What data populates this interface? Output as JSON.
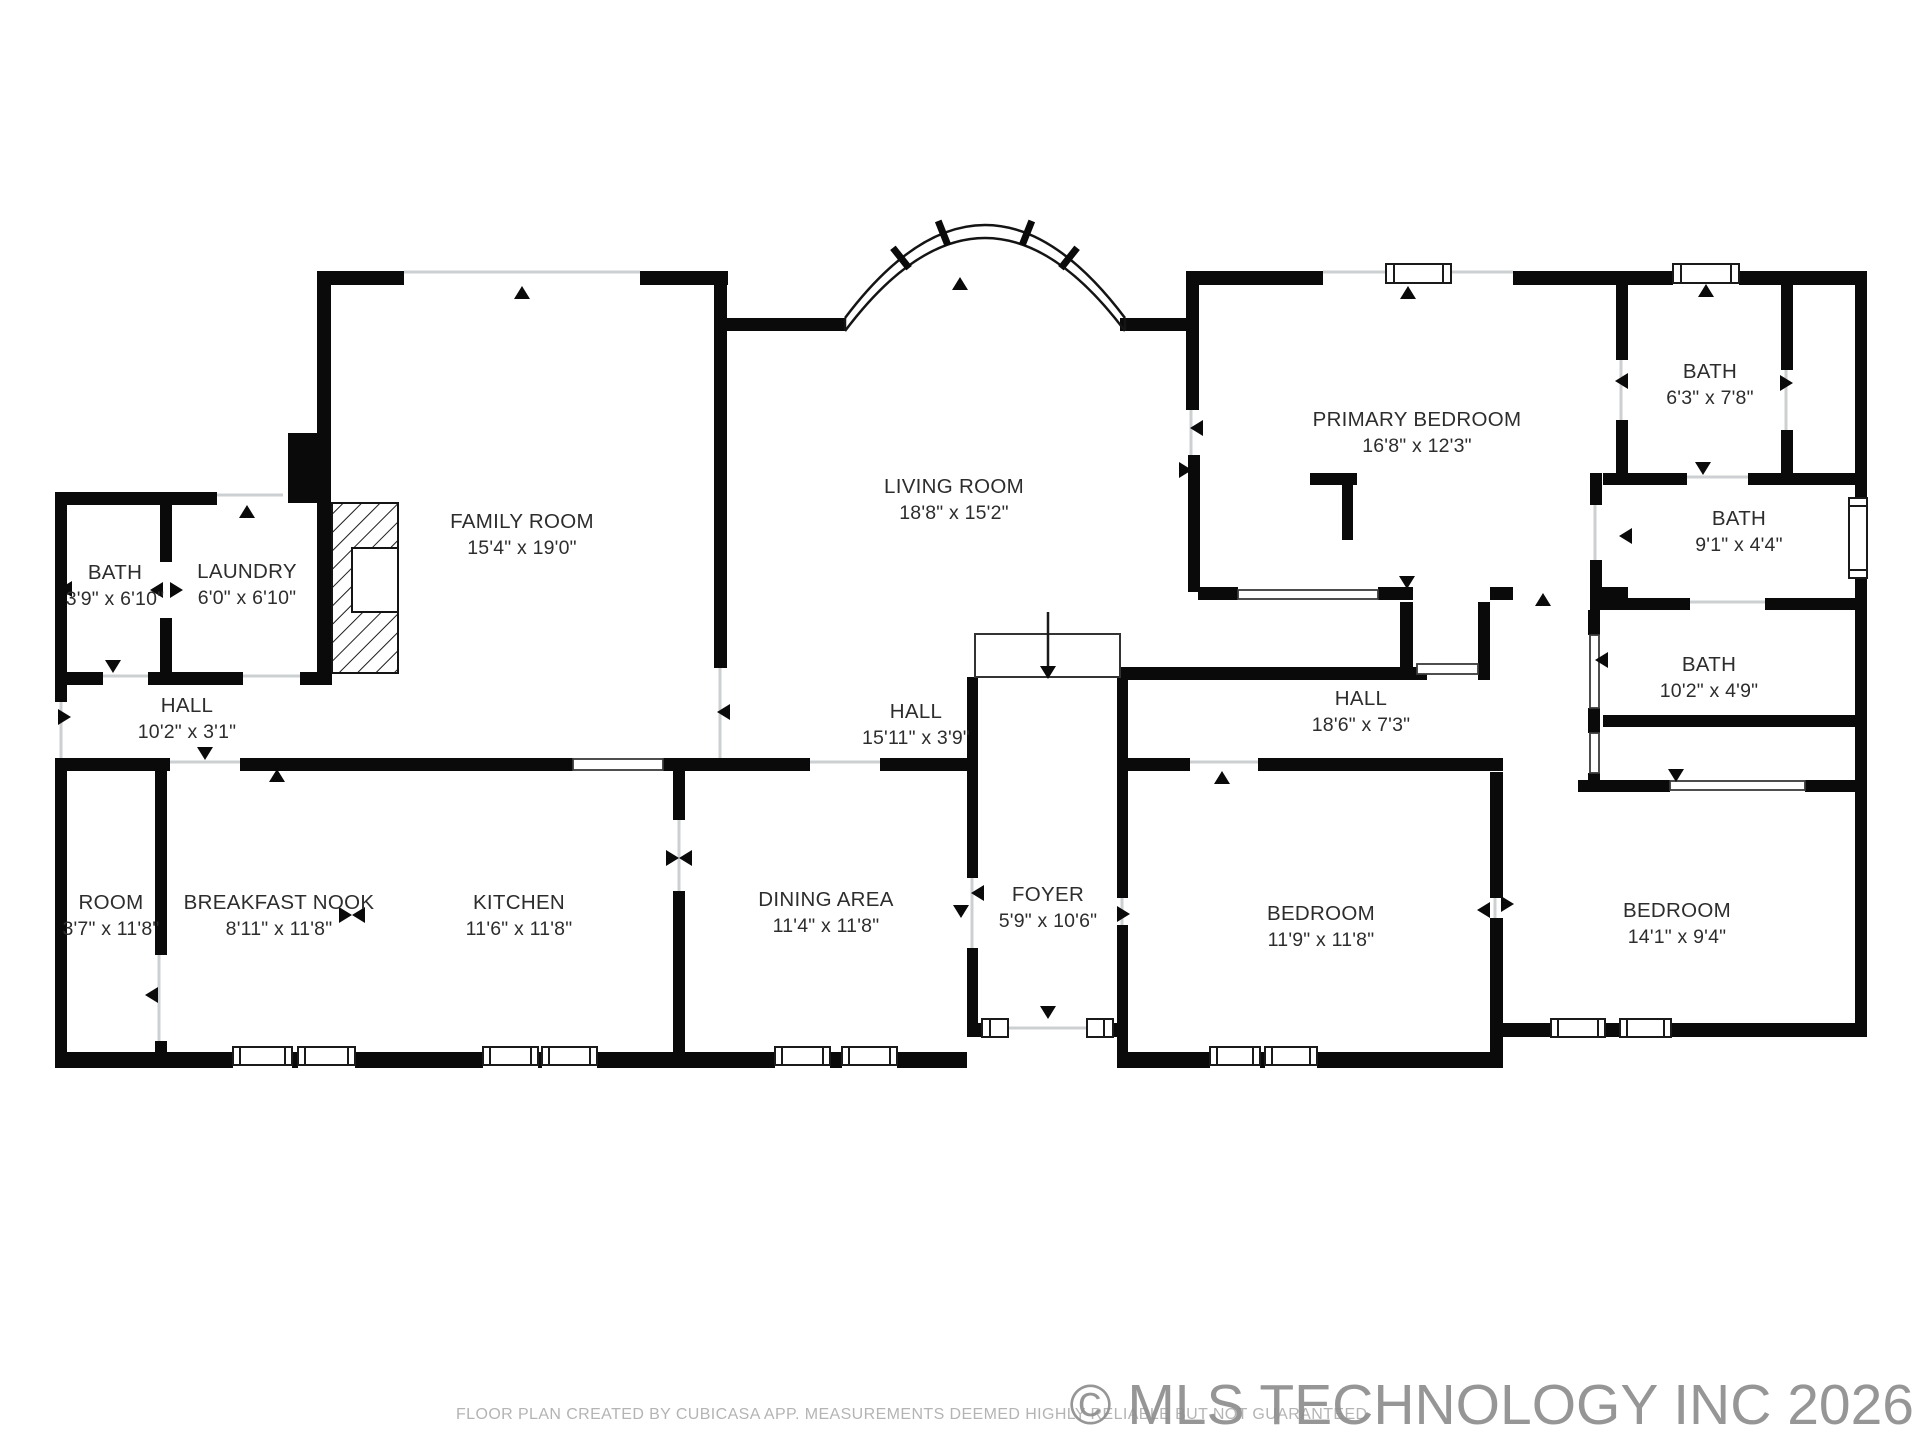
{
  "footer": {
    "disclaimer": "FLOOR PLAN CREATED BY CUBICASA APP. MEASUREMENTS DEEMED HIGHLY RELIABLE BUT NOT GUARANTEED",
    "watermark": "© MLS TECHNOLOGY INC 2026"
  },
  "rooms": [
    {
      "id": "family-room",
      "name": "FAMILY ROOM",
      "dims": "15'4\" x 19'0\"",
      "cx": 522,
      "cy": 535
    },
    {
      "id": "living-room",
      "name": "LIVING ROOM",
      "dims": "18'8\" x 15'2\"",
      "cx": 954,
      "cy": 500
    },
    {
      "id": "primary-bedroom",
      "name": "PRIMARY BEDROOM",
      "dims": "16'8\" x 12'3\"",
      "cx": 1417,
      "cy": 433
    },
    {
      "id": "bath-1",
      "name": "BATH",
      "dims": "6'3\" x 7'8\"",
      "cx": 1710,
      "cy": 385
    },
    {
      "id": "bath-2",
      "name": "BATH",
      "dims": "9'1\" x 4'4\"",
      "cx": 1739,
      "cy": 532
    },
    {
      "id": "bath-3",
      "name": "BATH",
      "dims": "10'2\" x 4'9\"",
      "cx": 1709,
      "cy": 678
    },
    {
      "id": "bath-4",
      "name": "BATH",
      "dims": "3'9\" x 6'10\"",
      "cx": 115,
      "cy": 586
    },
    {
      "id": "laundry",
      "name": "LAUNDRY",
      "dims": "6'0\" x 6'10\"",
      "cx": 247,
      "cy": 585
    },
    {
      "id": "hall-1",
      "name": "HALL",
      "dims": "10'2\" x 3'1\"",
      "cx": 187,
      "cy": 719
    },
    {
      "id": "hall-2",
      "name": "HALL",
      "dims": "15'11\" x 3'9\"",
      "cx": 916,
      "cy": 725
    },
    {
      "id": "hall-3",
      "name": "HALL",
      "dims": "18'6\" x 7'3\"",
      "cx": 1361,
      "cy": 712
    },
    {
      "id": "room",
      "name": "ROOM",
      "dims": "3'7\" x 11'8\"",
      "cx": 111,
      "cy": 916
    },
    {
      "id": "breakfast-nook",
      "name": "BREAKFAST NOOK",
      "dims": "8'11\" x 11'8\"",
      "cx": 279,
      "cy": 916
    },
    {
      "id": "kitchen",
      "name": "KITCHEN",
      "dims": "11'6\" x 11'8\"",
      "cx": 519,
      "cy": 916
    },
    {
      "id": "dining-area",
      "name": "DINING AREA",
      "dims": "11'4\" x 11'8\"",
      "cx": 826,
      "cy": 913
    },
    {
      "id": "foyer",
      "name": "FOYER",
      "dims": "5'9\" x 10'6\"",
      "cx": 1048,
      "cy": 908
    },
    {
      "id": "bedroom-1",
      "name": "BEDROOM",
      "dims": "11'9\" x 11'8\"",
      "cx": 1321,
      "cy": 927
    },
    {
      "id": "bedroom-2",
      "name": "BEDROOM",
      "dims": "14'1\" x 9'4\"",
      "cx": 1677,
      "cy": 924
    }
  ]
}
